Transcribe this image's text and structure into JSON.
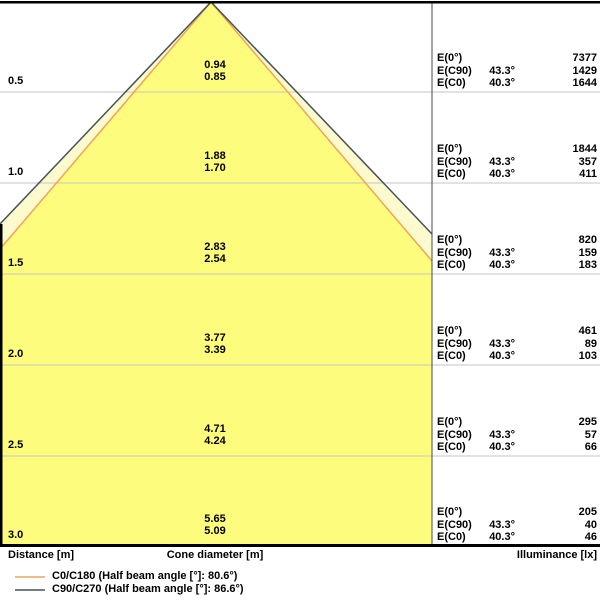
{
  "colors": {
    "cone_outer_fill": "#FDFBCE",
    "cone_inner_fill": "#FDFC7D",
    "c0_line": "#EFA35B",
    "c90_line": "#47525B",
    "grid_line": "#C6C6C6",
    "border": "#000000",
    "separator": "#4A4A4A"
  },
  "chart_data": {
    "type": "area",
    "description": "Luminaire light cone diagram: cone diameter and illuminance vs. distance",
    "axes": {
      "distance_label": "Distance [m]",
      "cone_diameter_label": "Cone diameter [m]",
      "illuminance_label": "Illuminance [lx]"
    },
    "half_beam_angles": {
      "C0_C180": "80.6°",
      "C90_C270": "86.6°"
    },
    "rows": [
      {
        "distance": "0.5",
        "cone_diameter_c90": "0.94",
        "cone_diameter_c0": "0.85",
        "table": [
          {
            "label": "E(0°)",
            "angle": "",
            "value": "7377"
          },
          {
            "label": "E(C90)",
            "angle": "43.3°",
            "value": "1429"
          },
          {
            "label": "E(C0)",
            "angle": "40.3°",
            "value": "1644"
          }
        ]
      },
      {
        "distance": "1.0",
        "cone_diameter_c90": "1.88",
        "cone_diameter_c0": "1.70",
        "table": [
          {
            "label": "E(0°)",
            "angle": "",
            "value": "1844"
          },
          {
            "label": "E(C90)",
            "angle": "43.3°",
            "value": "357"
          },
          {
            "label": "E(C0)",
            "angle": "40.3°",
            "value": "411"
          }
        ]
      },
      {
        "distance": "1.5",
        "cone_diameter_c90": "2.83",
        "cone_diameter_c0": "2.54",
        "table": [
          {
            "label": "E(0°)",
            "angle": "",
            "value": "820"
          },
          {
            "label": "E(C90)",
            "angle": "43.3°",
            "value": "159"
          },
          {
            "label": "E(C0)",
            "angle": "40.3°",
            "value": "183"
          }
        ]
      },
      {
        "distance": "2.0",
        "cone_diameter_c90": "3.77",
        "cone_diameter_c0": "3.39",
        "table": [
          {
            "label": "E(0°)",
            "angle": "",
            "value": "461"
          },
          {
            "label": "E(C90)",
            "angle": "43.3°",
            "value": "89"
          },
          {
            "label": "E(C0)",
            "angle": "40.3°",
            "value": "103"
          }
        ]
      },
      {
        "distance": "2.5",
        "cone_diameter_c90": "4.71",
        "cone_diameter_c0": "4.24",
        "table": [
          {
            "label": "E(0°)",
            "angle": "",
            "value": "295"
          },
          {
            "label": "E(C90)",
            "angle": "43.3°",
            "value": "57"
          },
          {
            "label": "E(C0)",
            "angle": "40.3°",
            "value": "66"
          }
        ]
      },
      {
        "distance": "3.0",
        "cone_diameter_c90": "5.65",
        "cone_diameter_c0": "5.09",
        "table": [
          {
            "label": "E(0°)",
            "angle": "",
            "value": "205"
          },
          {
            "label": "E(C90)",
            "angle": "43.3°",
            "value": "40"
          },
          {
            "label": "E(C0)",
            "angle": "40.3°",
            "value": "46"
          }
        ]
      }
    ]
  },
  "legend": [
    {
      "name": "C0/C180",
      "label": "C0/C180 (Half beam angle [°]: 80.6°)",
      "color": "#EFA35B"
    },
    {
      "name": "C90/C270",
      "label": "C90/C270 (Half beam angle [°]: 86.6°)",
      "color": "#47525B"
    }
  ]
}
